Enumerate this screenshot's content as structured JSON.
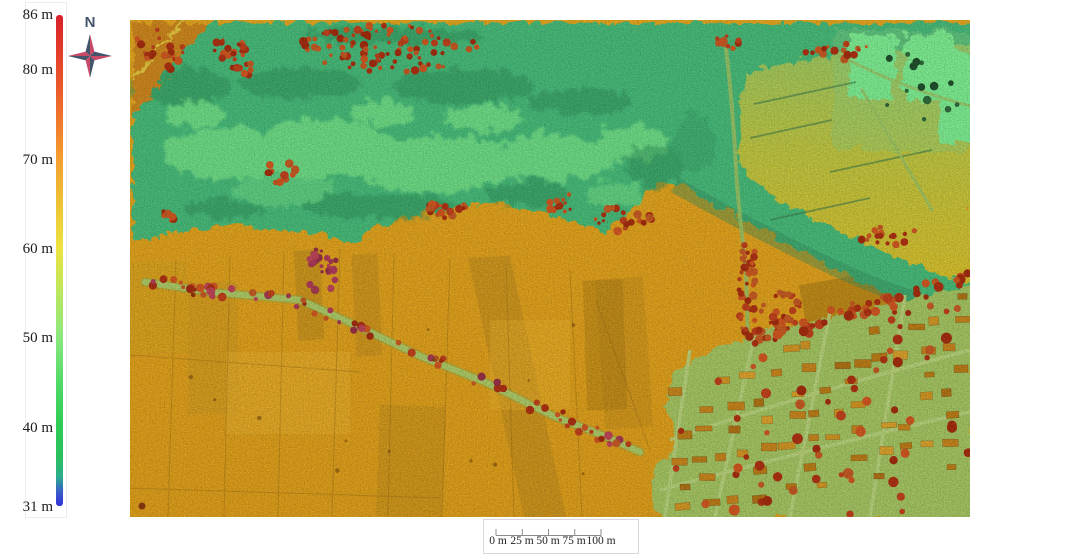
{
  "figure": {
    "type": "digital-elevation-model-map"
  },
  "legend": {
    "unit": "m",
    "min_value": 31,
    "max_value": 86,
    "ticks": [
      "86 m",
      "80 m",
      "70 m",
      "60 m",
      "50 m",
      "40 m",
      "31 m"
    ],
    "tick_values": [
      86,
      80,
      70,
      60,
      50,
      40,
      31
    ],
    "gradient_top_to_bottom": [
      "#D81F2B",
      "#E74A2A",
      "#F0702C",
      "#F49D2E",
      "#EEC233",
      "#EDE340",
      "#BEE75C",
      "#8BE87E",
      "#50D968",
      "#2FCC55",
      "#2BC05E",
      "#2BAE8C",
      "#3A60C8",
      "#3030D8"
    ]
  },
  "compass": {
    "label": "N"
  },
  "scale_bar": {
    "labels": [
      "0 m",
      "25 m",
      "50 m",
      "75 m",
      "100 m"
    ]
  },
  "colors": {
    "valley_green": "#46BD7A",
    "light_green_floodplain": "#72E388",
    "farmland_orange": "#E2A41C",
    "upper_fields_green_yellow": "#9ECB62",
    "bright_green_patches": "#7EF193",
    "village_ground_green": "#A6C762",
    "tree_red": "#C2411A",
    "compass_dark": "#44546B",
    "compass_red": "#C84A66"
  }
}
